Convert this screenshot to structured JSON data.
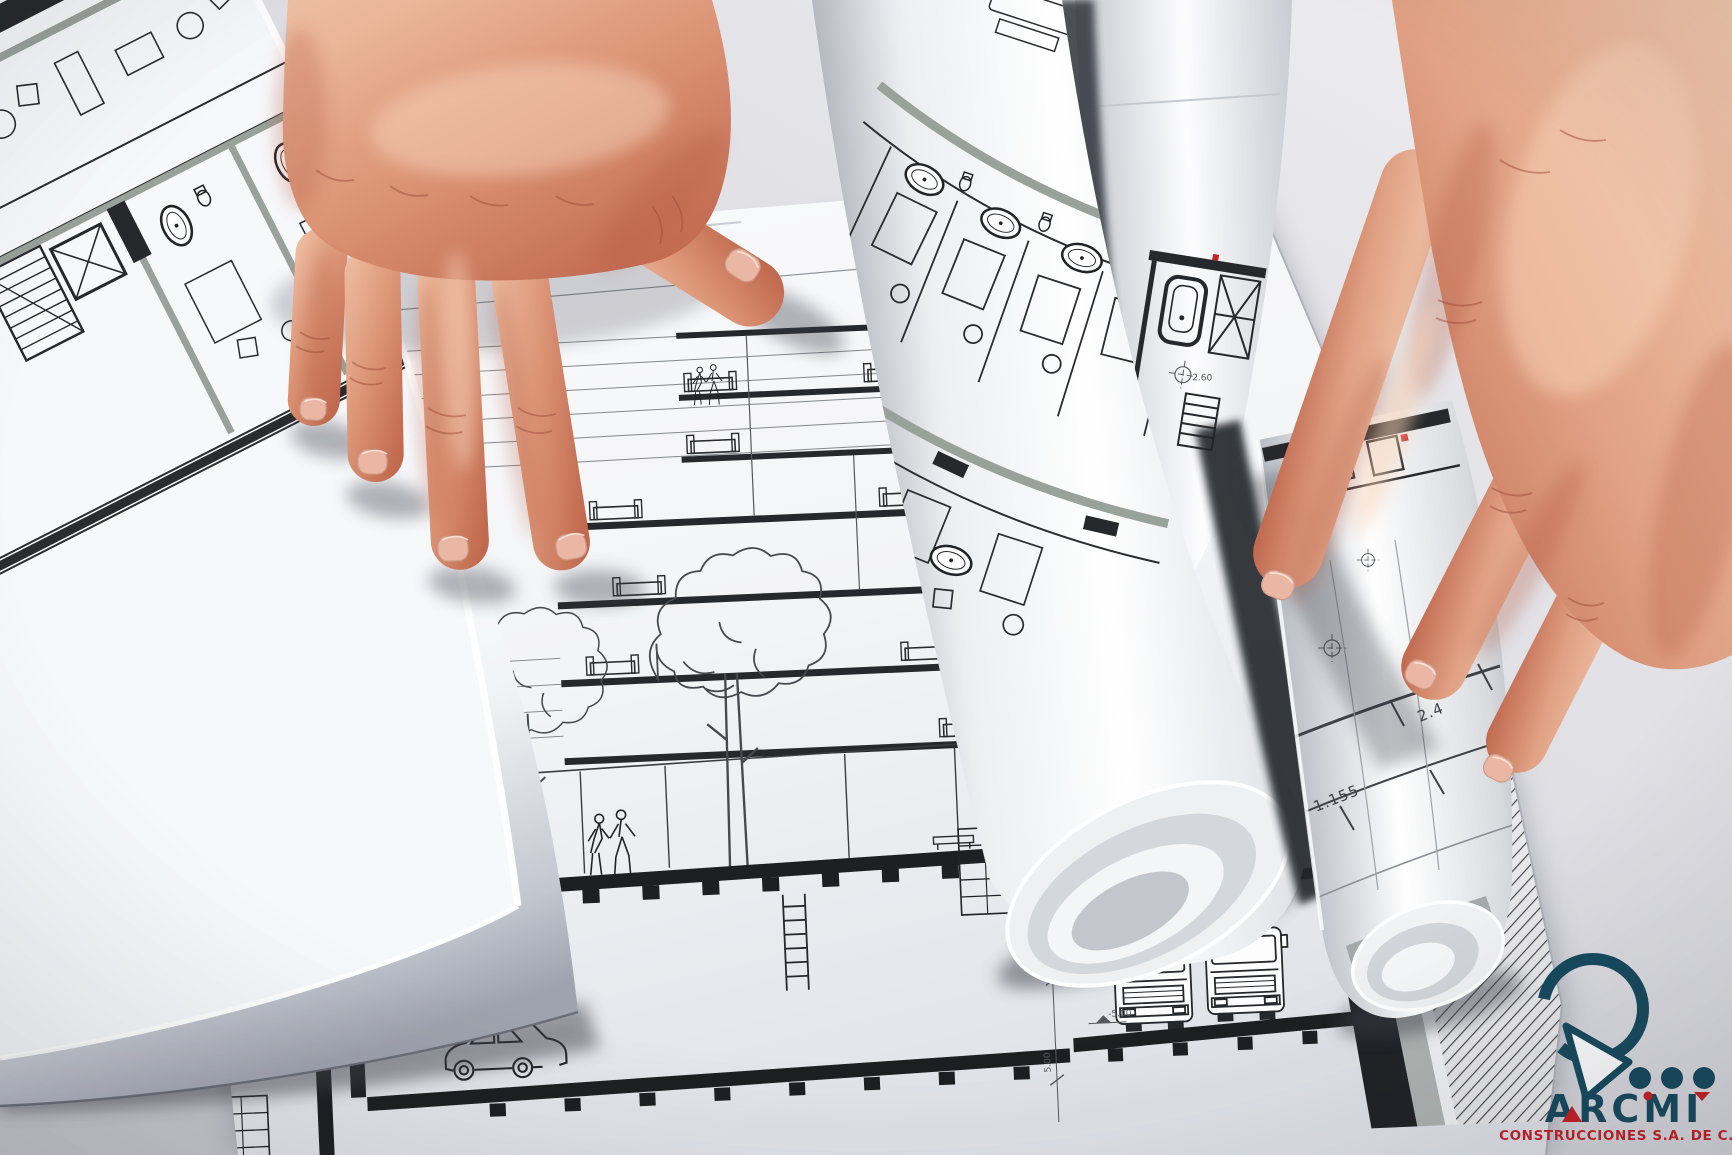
{
  "scene": {
    "type": "photograph",
    "subject": "Two hands reviewing rolled architectural blueprint drawings spread on a table"
  },
  "logo": {
    "wordmark": "ARCMI",
    "subtitle": "CONSTRUCCIONES S.A. DE C.V.",
    "mark": "circle-arrow-with-three-dots",
    "colors": {
      "teal": "#174a5f",
      "red": "#c62127"
    }
  },
  "blueprints": {
    "flat_sheet": {
      "content": "multi-storey building cross-section: floors with sofas, trees and pedestrians at street level, car in basement parking, two trucks in lower service bay, hatched ground at right",
      "story_dims": [
        "4.00",
        "3.20",
        "4.00",
        "5.00",
        "4.20",
        "5.00",
        "5.00"
      ],
      "level_labels": [
        "0.00",
        "-5.00"
      ]
    },
    "held_roll": {
      "content": "rolled plan pinched by right hand",
      "dims": [
        "1.155",
        "2.4"
      ]
    },
    "plain_roll": {
      "content": "roll with bathroom / stair detail",
      "dims": [
        "2.60"
      ]
    },
    "middle_roll": {
      "content": "curved hotel floor plan with guest rooms and bathrooms"
    },
    "left_roll": {
      "content": "curled sheet of guest-room floor plans with oval bathtubs"
    }
  },
  "palette": {
    "table": "#e7e6ea",
    "paper": "#f8f8fa",
    "ink": "#2a2c2f",
    "wall_gray": "#99a19b",
    "skin_base": "#e0a183",
    "skin_shadow": "#b95f47"
  }
}
